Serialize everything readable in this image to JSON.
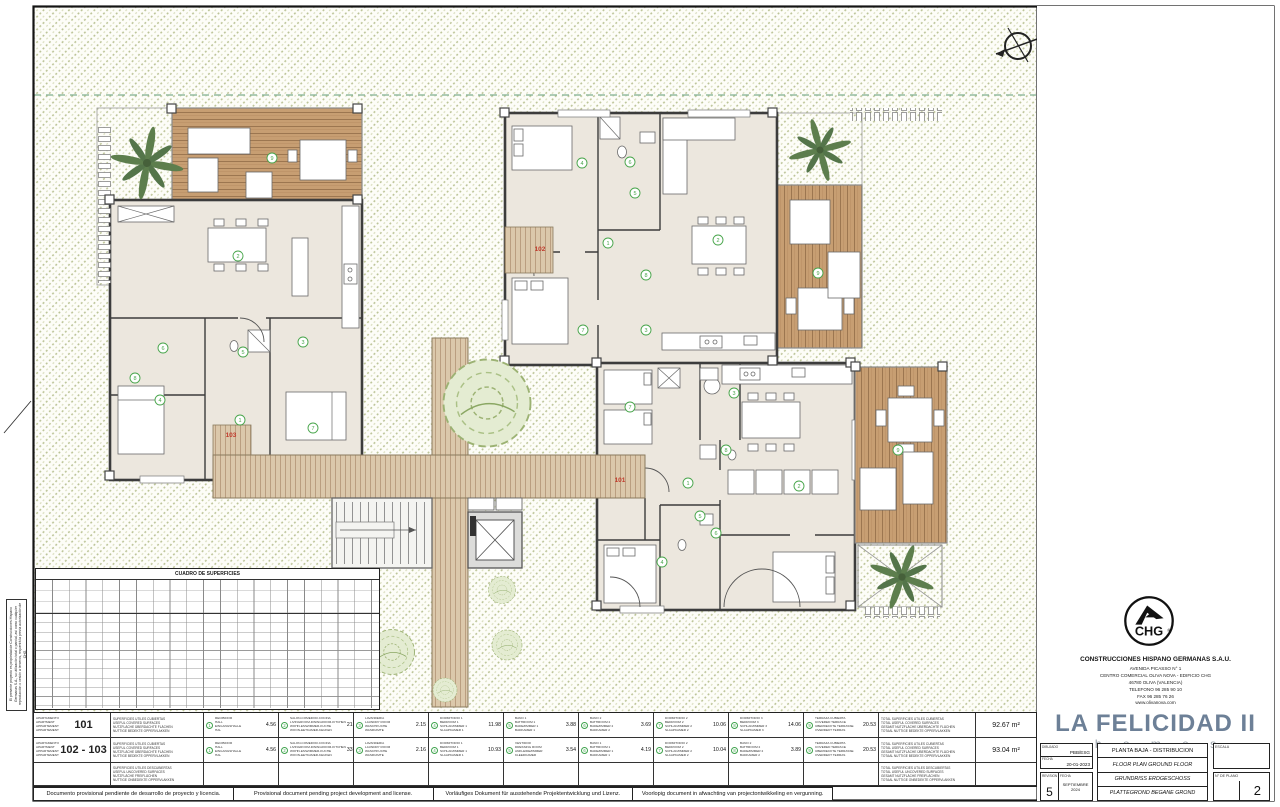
{
  "sheet": {
    "disclaimers": [
      "Documento provisional pendiente de desarrollo de proyecto y licencia.",
      "Provisional document pending project development and license.",
      "Vorläufiges Dokument für ausstehende Projektentwicklung und Lizenz.",
      "Voorlopig document in afwachting van projectontwikkeling en vergunning."
    ],
    "side_note": "El presente proyecto es propiedad de Construcciones Hispano Germanas S.A., su utilización total o parcial, así como cualquier reproducción o cesión a terceros, requerirá la previa autorización de CHG."
  },
  "surface_table": {
    "title": "CUADRO DE SUPERFICIES"
  },
  "plan": {
    "unit_labels": [
      {
        "label": "103",
        "x": 231,
        "y": 437
      },
      {
        "label": "102",
        "x": 540,
        "y": 251
      },
      {
        "label": "101",
        "x": 620,
        "y": 482
      }
    ],
    "room_markers": [
      {
        "n": "9",
        "x": 272,
        "y": 158
      },
      {
        "n": "2",
        "x": 238,
        "y": 256
      },
      {
        "n": "6",
        "x": 163,
        "y": 348
      },
      {
        "n": "5",
        "x": 243,
        "y": 352
      },
      {
        "n": "3",
        "x": 303,
        "y": 342
      },
      {
        "n": "1",
        "x": 240,
        "y": 420
      },
      {
        "n": "4",
        "x": 160,
        "y": 400
      },
      {
        "n": "7",
        "x": 313,
        "y": 428
      },
      {
        "n": "8",
        "x": 135,
        "y": 378
      },
      {
        "n": "4",
        "x": 582,
        "y": 163
      },
      {
        "n": "6",
        "x": 630,
        "y": 162
      },
      {
        "n": "5",
        "x": 635,
        "y": 193
      },
      {
        "n": "1",
        "x": 608,
        "y": 243
      },
      {
        "n": "2",
        "x": 718,
        "y": 240
      },
      {
        "n": "8",
        "x": 646,
        "y": 275
      },
      {
        "n": "7",
        "x": 583,
        "y": 330
      },
      {
        "n": "3",
        "x": 646,
        "y": 330
      },
      {
        "n": "9",
        "x": 818,
        "y": 273
      },
      {
        "n": "7",
        "x": 630,
        "y": 407
      },
      {
        "n": "3",
        "x": 734,
        "y": 393
      },
      {
        "n": "8",
        "x": 726,
        "y": 450
      },
      {
        "n": "1",
        "x": 688,
        "y": 483
      },
      {
        "n": "2",
        "x": 799,
        "y": 486
      },
      {
        "n": "6",
        "x": 716,
        "y": 533
      },
      {
        "n": "5",
        "x": 700,
        "y": 516
      },
      {
        "n": "4",
        "x": 662,
        "y": 562
      },
      {
        "n": "9",
        "x": 898,
        "y": 450
      }
    ]
  },
  "legend": {
    "apartment_word": [
      "APARTAMENTO",
      "APARTMENT",
      "APPARTEMENT",
      "APPARTEMENT"
    ],
    "covered_label": [
      "SUPERFICIES UTILES CUBIERTAS",
      "USEFUL COVERED SURFACES",
      "NUTZFLÄCHE ÜBERDACHTE FLÄCHEN",
      "NUTTIGE BEDEKTE OPPERVLAKKEN"
    ],
    "uncovered_label": [
      "SUPERFICIES UTILES DESCUBIERTAS",
      "USEFUL UNCOVERED SURFACES",
      "NUTZFLÄCHE FREIFLÄCHEN",
      "NUTTIGE ONBEDEKTE OPPERVLAKKEN"
    ],
    "total_covered_label": [
      "TOTAL SUPERFICIES UTILES CUBIERTAS",
      "TOTAL USEFUL COVERED SURFACES",
      "GESAMT NUTZFLÄCHE ÜBERDACHTE FLÄCHEN",
      "TOTAAL NUTTIGE BEDEKTE OPPERVLAKKEN"
    ],
    "total_uncovered_label": [
      "TOTAL SUPERFICIES UTILES DESCUBIERTAS",
      "TOTAL USEFUL UNCOVERED SURFACES",
      "GESAMT NUTZFLÄCHE FREIFLÄCHEN",
      "TOTAAL NUTTIGE ONBEDEKTE OPPERVLAKKEN"
    ],
    "rows": [
      {
        "apartment": "101",
        "total": "92.67 m²",
        "rooms": [
          {
            "n": "1",
            "names": [
              "RECIBIDOR",
              "HALL",
              "EINGANGSHALLE",
              "HAL"
            ],
            "value": "4.56"
          },
          {
            "n": "2",
            "names": [
              "SALON-COMEDOR-COCINA",
              "LIVINGROOM-DININGROOM-KITCHEN",
              "WOHN-ESSZIMMER-KÜCHE",
              "WOON-EETKAMER-KEUKEN"
            ],
            "value": "21.80"
          },
          {
            "n": "3",
            "names": [
              "LAVANDERIA",
              "LAUNDRY ROOM",
              "WASCHKÜCHE",
              "WASRUIMTE"
            ],
            "value": "2.15"
          },
          {
            "n": "4",
            "names": [
              "DORMITORIO 1",
              "BEDROOM 1",
              "SCHLAFZIMMER 1",
              "SLAAPKAMER 1"
            ],
            "value": "11.98"
          },
          {
            "n": "5",
            "names": [
              "BAÑO 1",
              "BATHROOM 1",
              "BADEZIMMER 1",
              "BADKAMER 1"
            ],
            "value": "3.88"
          },
          {
            "n": "6",
            "names": [
              "BAÑO 2",
              "BATHROOM 2",
              "BADEZIMMER 2",
              "BADKAMER 2"
            ],
            "value": "3.69"
          },
          {
            "n": "7",
            "names": [
              "DORMITORIO 2",
              "BEDROOM 2",
              "SCHLAFZIMMER 2",
              "SLAAPKAMER 2"
            ],
            "value": "10.06"
          },
          {
            "n": "8",
            "names": [
              "DORMITORIO 3",
              "BEDROOM 3",
              "SCHLAFZIMMER 3",
              "SLAAPKAMER 3"
            ],
            "value": "14.06"
          },
          {
            "n": "9",
            "names": [
              "TERRAZA CUBIERTA",
              "COVERED TERRACE",
              "ÜBERDECKTE TERRASSE",
              "OVERDEKT TERRAS"
            ],
            "value": "20.53"
          }
        ]
      },
      {
        "apartment": "102 - 103",
        "total": "93.04 m²",
        "rooms": [
          {
            "n": "1",
            "names": [
              "RECIBIDOR",
              "HALL",
              "EINGANGSHALLE",
              "HAL"
            ],
            "value": "4.56"
          },
          {
            "n": "2",
            "names": [
              "SALON-COMEDOR-COCINA",
              "LIVINGROOM-DININGROOM-KITCHEN",
              "WOHN-ESSZIMMER-KÜCHE",
              "WOON-EETKAMER-KEUKEN"
            ],
            "value": "33.33"
          },
          {
            "n": "3",
            "names": [
              "LAVANDERIA",
              "LAUNDRY ROOM",
              "WASCHKÜCHE",
              "WASRUIMTE"
            ],
            "value": "2.16"
          },
          {
            "n": "4",
            "names": [
              "DORMITORIO 1",
              "BEDROOM 1",
              "SCHLAFZIMMER 1",
              "SLAAPKAMER 1"
            ],
            "value": "10.93"
          },
          {
            "n": "5",
            "names": [
              "VESTIDOR",
              "DRESSING ROOM",
              "ANKLEIDEZIMMER",
              "KLEEDKAMER"
            ],
            "value": "3.54"
          },
          {
            "n": "6",
            "names": [
              "BAÑO 1",
              "BATHROOM 1",
              "BADEZIMMER 1",
              "BADKAMER 1"
            ],
            "value": "4.19"
          },
          {
            "n": "7",
            "names": [
              "DORMITORIO 2",
              "BEDROOM 2",
              "SCHLAFZIMMER 2",
              "SLAAPKAMER 2"
            ],
            "value": "10.04"
          },
          {
            "n": "8",
            "names": [
              "BAÑO 2",
              "BATHROOM 2",
              "BADEZIMMER 2",
              "BADKAMER 2"
            ],
            "value": "3.89"
          },
          {
            "n": "9",
            "names": [
              "TERRAZA CUBIERTA",
              "COVERED TERRACE",
              "ÜBERDECKTE TERRASSE",
              "OVERDEKT TERRAS"
            ],
            "value": "20.53"
          }
        ]
      }
    ]
  },
  "title_block": {
    "logo_text": "CHG",
    "company": "CONSTRUCCIONES HISPANO GERMANAS S.A.U.",
    "address_lines": [
      "AVENIDA PICASSO N° 1",
      "CENTRO COMERCIAL OLIVA NOVA - EDIFICIO CHG",
      "46780 OLIVA (VALENCIA)",
      "TELEFONO 96 285 90 10",
      "FAX 96 285 76 26",
      "www.olivanova.com"
    ],
    "brand": "LA FELICIDAD II",
    "brand_sub": "h o m e s",
    "drawn_label": "DIBUJADO",
    "drawn_value": "PBB/ESG",
    "date_label": "FECHA",
    "date_value": "20-01-2023",
    "revision_label": "REVISION",
    "revision_value": "5",
    "revision_date_label": "FECHA",
    "revision_date_value": "SEPTIEMBRE 2024",
    "titles": [
      "PLANTA BAJA - DISTRIBUCION",
      "FLOOR PLAN GROUND FLOOR",
      "GRUNDRISS ERDGESCHOSS",
      "PLATTEGROND BEGANE GROND"
    ],
    "scale_label": "ESCALA",
    "plan_no_label": "N° DE PLANO",
    "plan_no_value": "2"
  }
}
